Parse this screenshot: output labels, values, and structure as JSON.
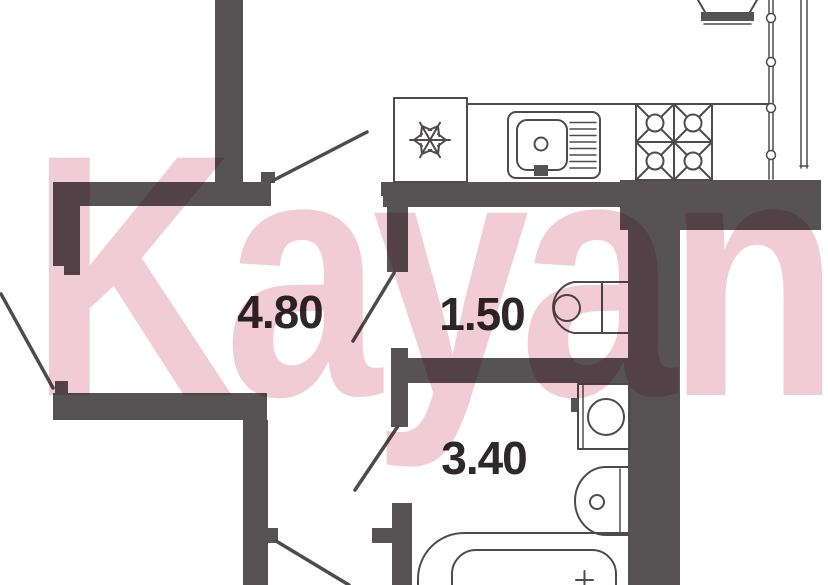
{
  "watermark": {
    "text": "Kayan"
  },
  "rooms": {
    "hallway": {
      "area": "4.80"
    },
    "wc": {
      "area": "1.50"
    },
    "bathroom": {
      "area": "3.40"
    }
  },
  "fixtures": {
    "kitchen": [
      "refrigerator-snowflake-icon",
      "kitchen-sink-icon",
      "stove-four-burners-icon"
    ],
    "wc": [
      "toilet-icon"
    ],
    "bathroom": [
      "washing-machine-icon",
      "washbasin-icon",
      "bathtub-icon"
    ],
    "windows": [
      "window-mullion-line",
      "balcony-glazing-line"
    ],
    "doors": [
      "kitchen-door-swing",
      "left-room-door-swing",
      "wc-door-swing",
      "bathroom-door-swing",
      "bottom-room-door-swing"
    ]
  },
  "colors": {
    "background": "#ffffff",
    "wall": "#575254",
    "line": "#4f4b4d",
    "label": "#2e282a",
    "watermark": "#f1ccd6"
  }
}
